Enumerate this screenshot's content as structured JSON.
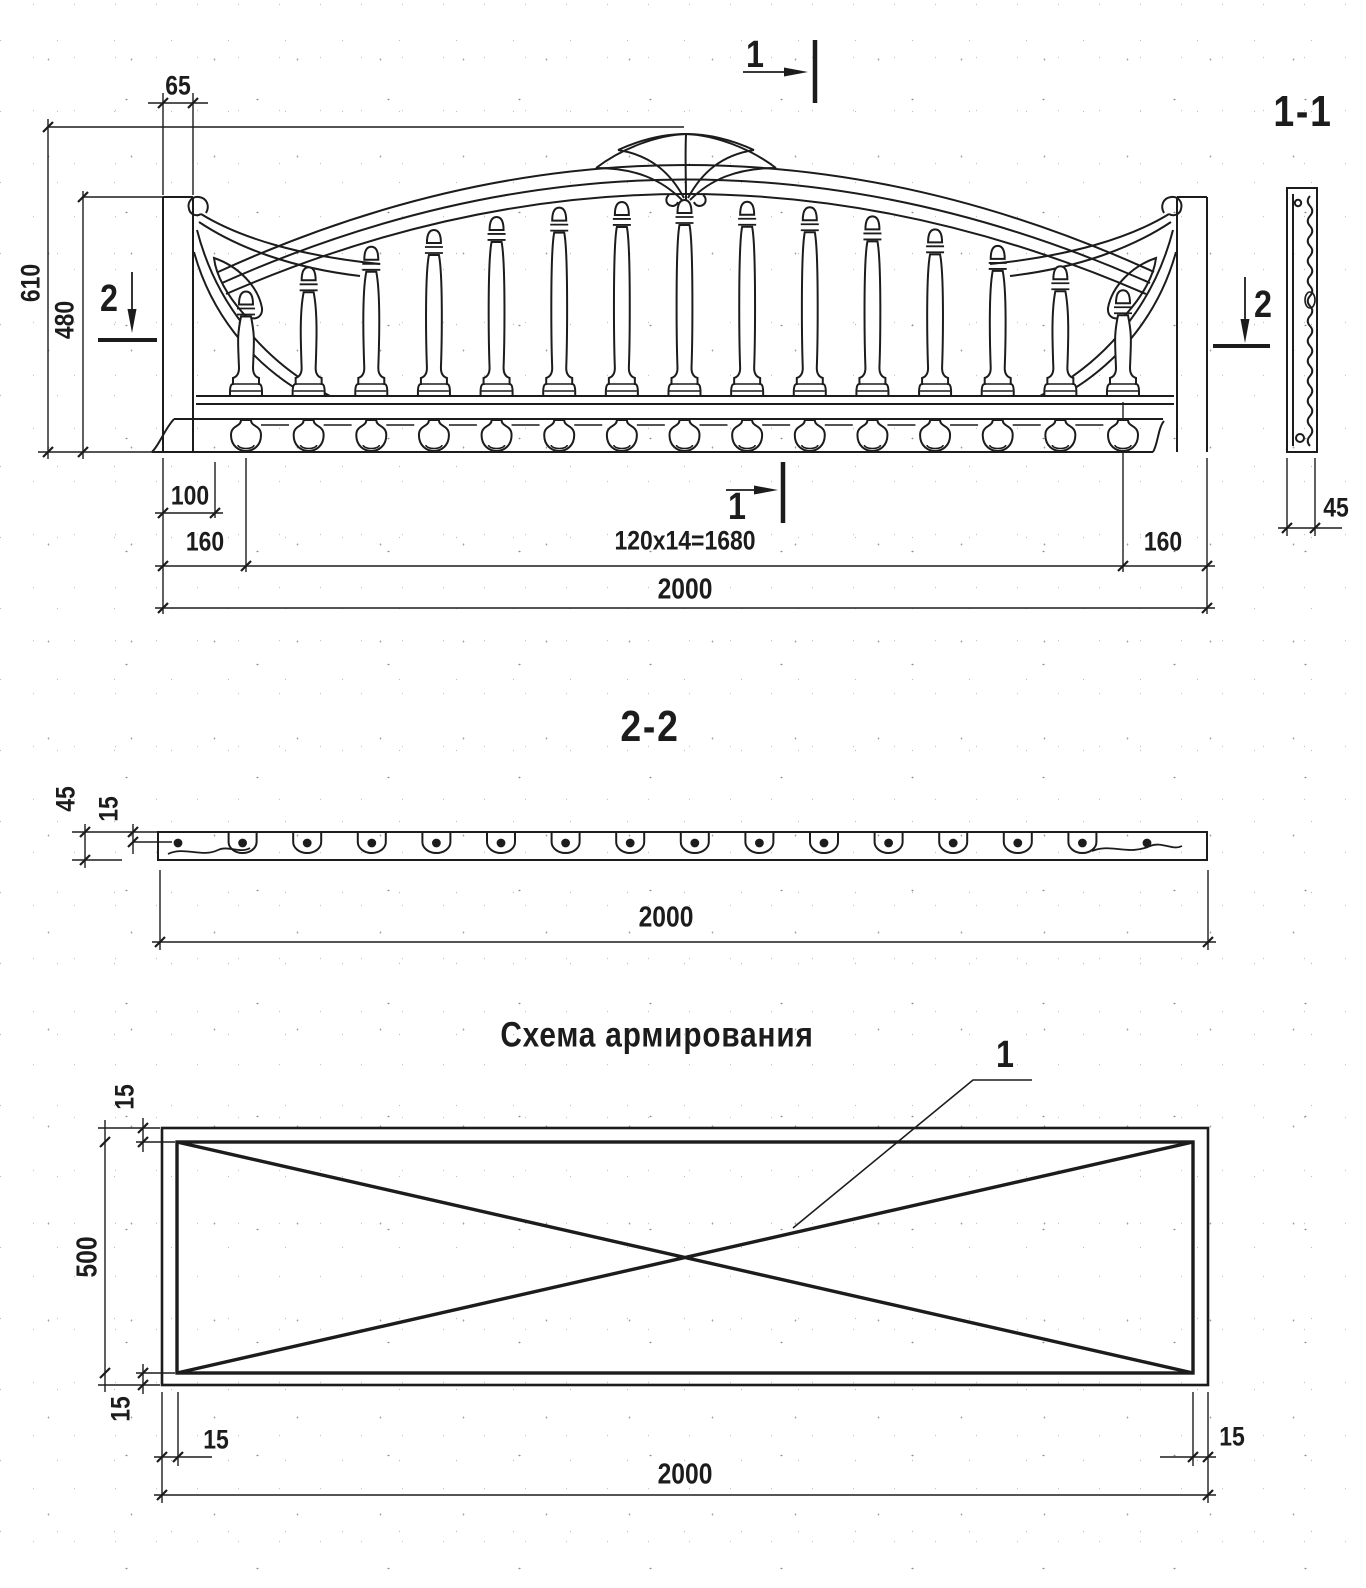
{
  "drawing": {
    "elevation": {
      "section_marks": {
        "top": "1",
        "bottom": "1",
        "left": "2",
        "right": "2"
      },
      "dims": {
        "top_width": "65",
        "height_total": "610",
        "height_post": "480",
        "base_offset": "100",
        "margin_left": "160",
        "baluster_spacing": "120x14=1680",
        "margin_right": "160",
        "width_total": "2000"
      },
      "balusters_count": 15,
      "drops_count": 15
    },
    "side_view": {
      "label": "1-1",
      "dims": {
        "thickness": "45"
      }
    },
    "section_2_2": {
      "label": "2-2",
      "dims": {
        "thickness": "45",
        "rebar_offset": "15",
        "width": "2000"
      },
      "rebar_dots": 16
    },
    "reinforcement": {
      "title": "Схема армирования",
      "callout": "1",
      "dims": {
        "inset_top": "15",
        "height": "500",
        "inset_bottom": "15",
        "inset_left": "15",
        "width": "2000",
        "inset_right": "15"
      }
    }
  },
  "colors": {
    "ink": "#1c1c1c",
    "paper": "#ffffff"
  }
}
